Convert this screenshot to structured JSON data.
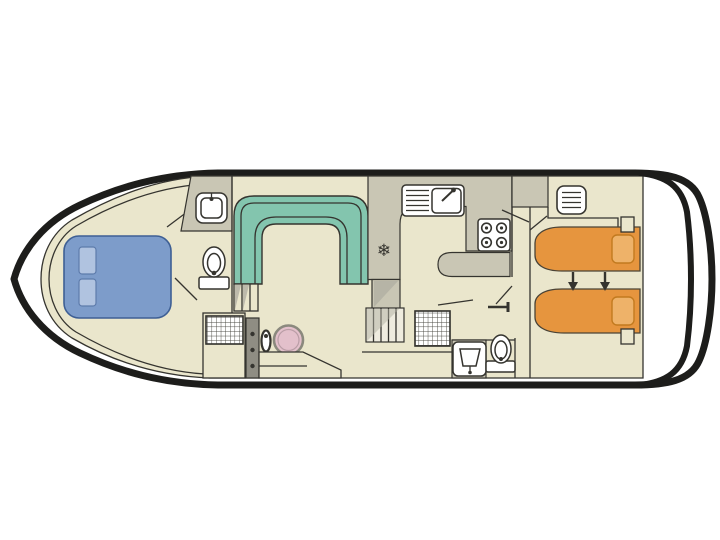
{
  "canvas": {
    "width": 720,
    "height": 540,
    "background": "#ffffff"
  },
  "colors": {
    "hull_outline": "#1d1d1b",
    "wall_line": "#35342f",
    "floor_beige": "#eae6cc",
    "zone_gray": "#c9c6b4",
    "shade_gray": "#b2afa2",
    "console_gray": "#8f8d83",
    "bench_teal": "#83c5ae",
    "bed_blue": "#7d9cca",
    "pillow_blue": "#b0c3e0",
    "bed_orange": "#e6953e",
    "pillow_orange": "#eeb269",
    "wheel_pink": "#e3c0cb",
    "fixture_white": "#ffffff"
  },
  "symbols": {
    "fridge_snowflake": "❄"
  },
  "icons": {
    "fridge": "snowflake-glyph",
    "galley_sink": "sink-with-drainboard-and-faucet",
    "stove": "four-burner-hob",
    "washbasin": "rounded-basin-with-tap",
    "toilet": "oval-bowl-with-cistern-base",
    "steering_wheel": "circle-wheel",
    "bed_convert_arrows": "two-down-arrows",
    "floor_hatch": "grid-mat",
    "vent": "slatted-grille"
  }
}
